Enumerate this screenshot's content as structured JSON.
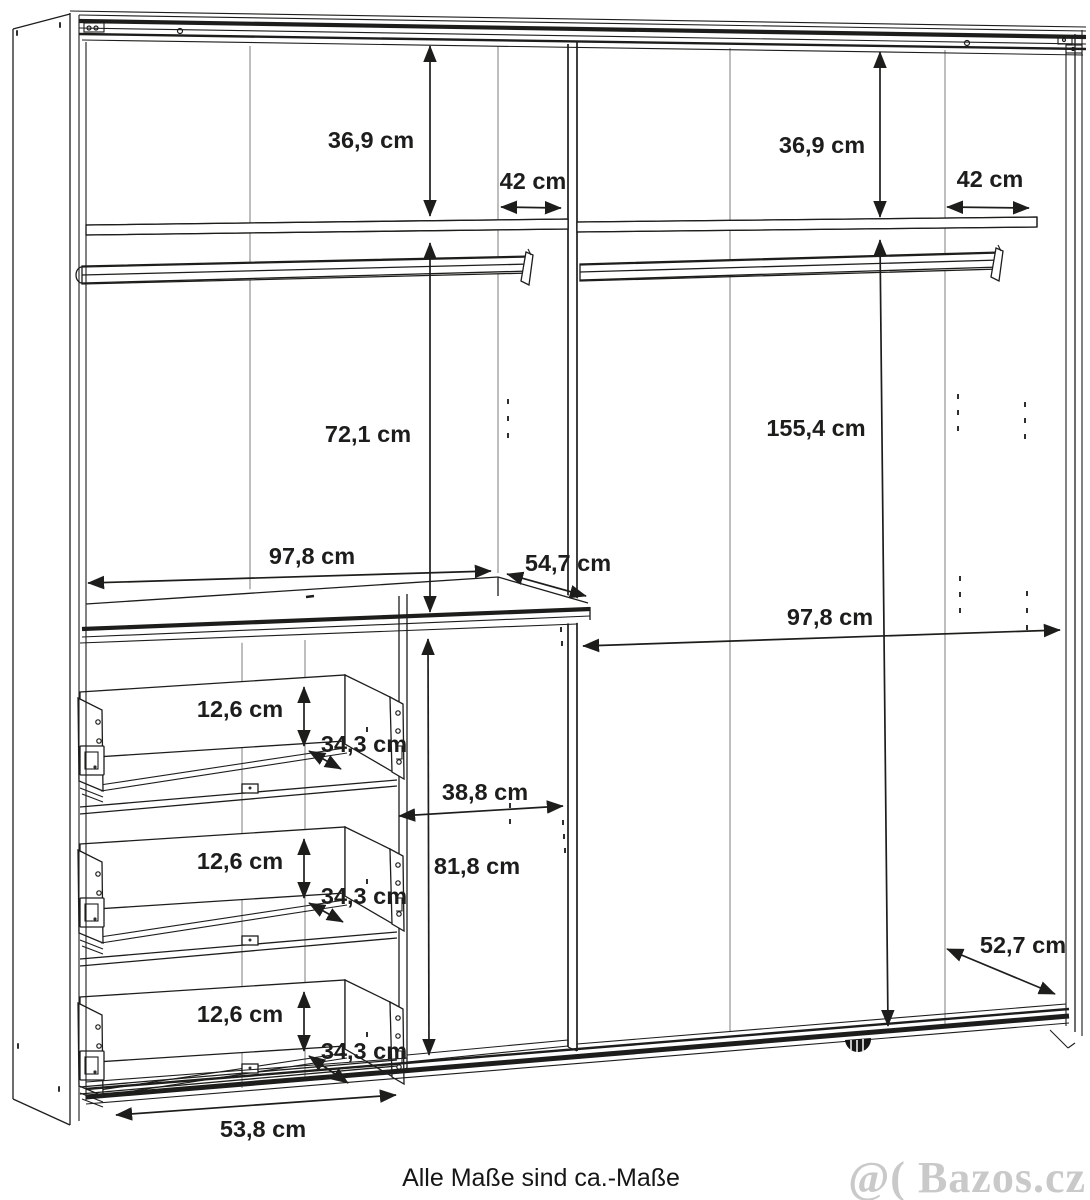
{
  "diagram": {
    "type": "furniture-dimension-drawing",
    "subject": "wardrobe interior schematic with sliding-door rails, shelves, clothes rails and three drawers",
    "note": "Alle Maße sind ca.-Maße",
    "watermark": "@( Bazos.cz",
    "colors": {
      "line": "#1d1d1b",
      "label": "#1d1d1b",
      "seam": "#9b9b9b",
      "watermark": "#c9c9c9"
    },
    "dimensions": {
      "left_top_shelf_height": "36,9 cm",
      "left_top_bay_width": "42 cm",
      "right_top_shelf_height": "36,9 cm",
      "right_top_bay_width": "42 cm",
      "left_hanging_height": "72,1 cm",
      "right_hanging_height": "155,4 cm",
      "left_section_width": "97,8 cm",
      "shelf_depth": "54,7 cm",
      "right_section_width": "97,8 cm",
      "drawer1_height": "12,6 cm",
      "drawer1_depth": "34,3 cm",
      "drawer2_height": "12,6 cm",
      "drawer2_depth": "34,3 cm",
      "drawer3_height": "12,6 cm",
      "drawer3_depth": "34,3 cm",
      "niche_width": "38,8 cm",
      "niche_height": "81,8 cm",
      "drawer_front_width": "53,8 cm",
      "bottom_depth": "52,7 cm"
    }
  }
}
